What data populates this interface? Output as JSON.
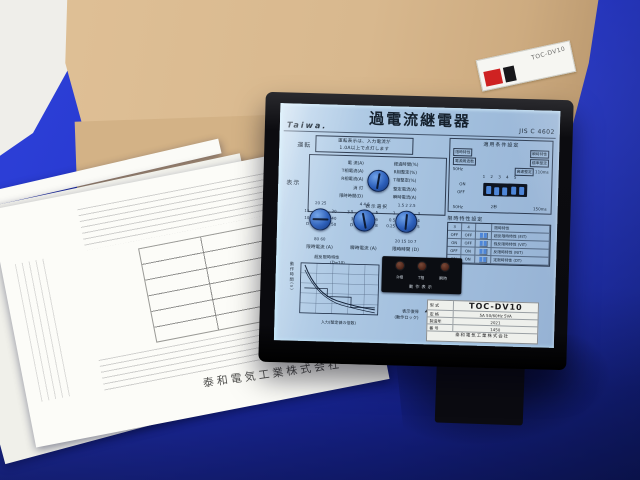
{
  "scene": {
    "backdrop_color": "#2334c8",
    "carton_color": "#d8b88e",
    "panel_color": "#a9c6e2"
  },
  "carton_label": {
    "model": "TOC-DV10"
  },
  "papers": {
    "footer": "泰和電気工業株式会社"
  },
  "device": {
    "brand": "Taiwa.",
    "title": "過電流継電器",
    "standard": "JIS C 4602",
    "run": {
      "label": "運転",
      "note": "運転表示は、入力電流が\n1.0A以上で点灯します"
    },
    "display": {
      "label": "表示",
      "caption": "表示選択",
      "left": "電 流(A)\nT相電流(A)\nR相電流(A)\n消 灯\n限時時間(D)",
      "right": "経過時間(%)\nR相整定(%)\nT相整定(%)\n整定電流(A)\n瞬時電流(A)"
    },
    "dials": [
      {
        "caption": "限時電流 (A)",
        "top": "20  25",
        "left": "15\n10\nD",
        "right": "30\n40\n50",
        "bottom": "80  60"
      },
      {
        "caption": "瞬時電流 (A)",
        "top": "4  4.5",
        "left": "3.5\n3\nD",
        "right": "5\n6\n8",
        "bottom": ""
      },
      {
        "caption": "限時時間 (D)",
        "top": "1.5  2  2.5",
        "left": "1\n0.5\n0.25",
        "right": "3\n4\n5",
        "bottom": "20 15 10 7"
      }
    ],
    "graph": {
      "title": "超反限時特性",
      "subtitle": "(D=10)",
      "ylabel": "動作時間(s)",
      "xlabel": "入力(整定値の倍数)"
    },
    "reset": {
      "label": "表示復帰\n(動作ロック)"
    },
    "conditions": {
      "title": "適用条件設定",
      "left_tag1": "限時特性",
      "left_tag2": "電源周波数",
      "left_value": "50Hz",
      "right_tag1": "瞬時特性",
      "right_tag2": "標準整定",
      "right_tag3": "高速整定",
      "right_value": "110ms",
      "numbers": "1 2 3 4 5",
      "on": "ON",
      "off": "OFF",
      "bottom_left": "50Hz",
      "bottom_mid": "2秒",
      "bottom_right": "150ms"
    },
    "time_table": {
      "title": "限時特性設定",
      "h1": "3",
      "h2": "4",
      "h3": "",
      "h4": "限時特性",
      "rows": [
        {
          "c1": "OFF",
          "c2": "OFF",
          "name": "超反限時特性 (EIT)"
        },
        {
          "c1": "ON",
          "c2": "OFF",
          "name": "強反限時特性 (VIT)"
        },
        {
          "c1": "OFF",
          "c2": "ON",
          "name": "反限時特性 (NIT)"
        },
        {
          "c1": "ON",
          "c2": "ON",
          "name": "定限時特性 (DT)"
        }
      ]
    },
    "indicators": {
      "l1": "R相",
      "l2": "T相",
      "l3": "瞬時",
      "caption": "動作表示"
    },
    "nameplate": {
      "k1": "型 式",
      "v1": "TOC-DV10",
      "k2": "定 格",
      "v2": "5A 50/60Hz 5VA",
      "k3": "製造年",
      "v3": "2021",
      "k4": "番 号",
      "v4": "1450",
      "company": "泰和電気工業株式会社"
    }
  }
}
